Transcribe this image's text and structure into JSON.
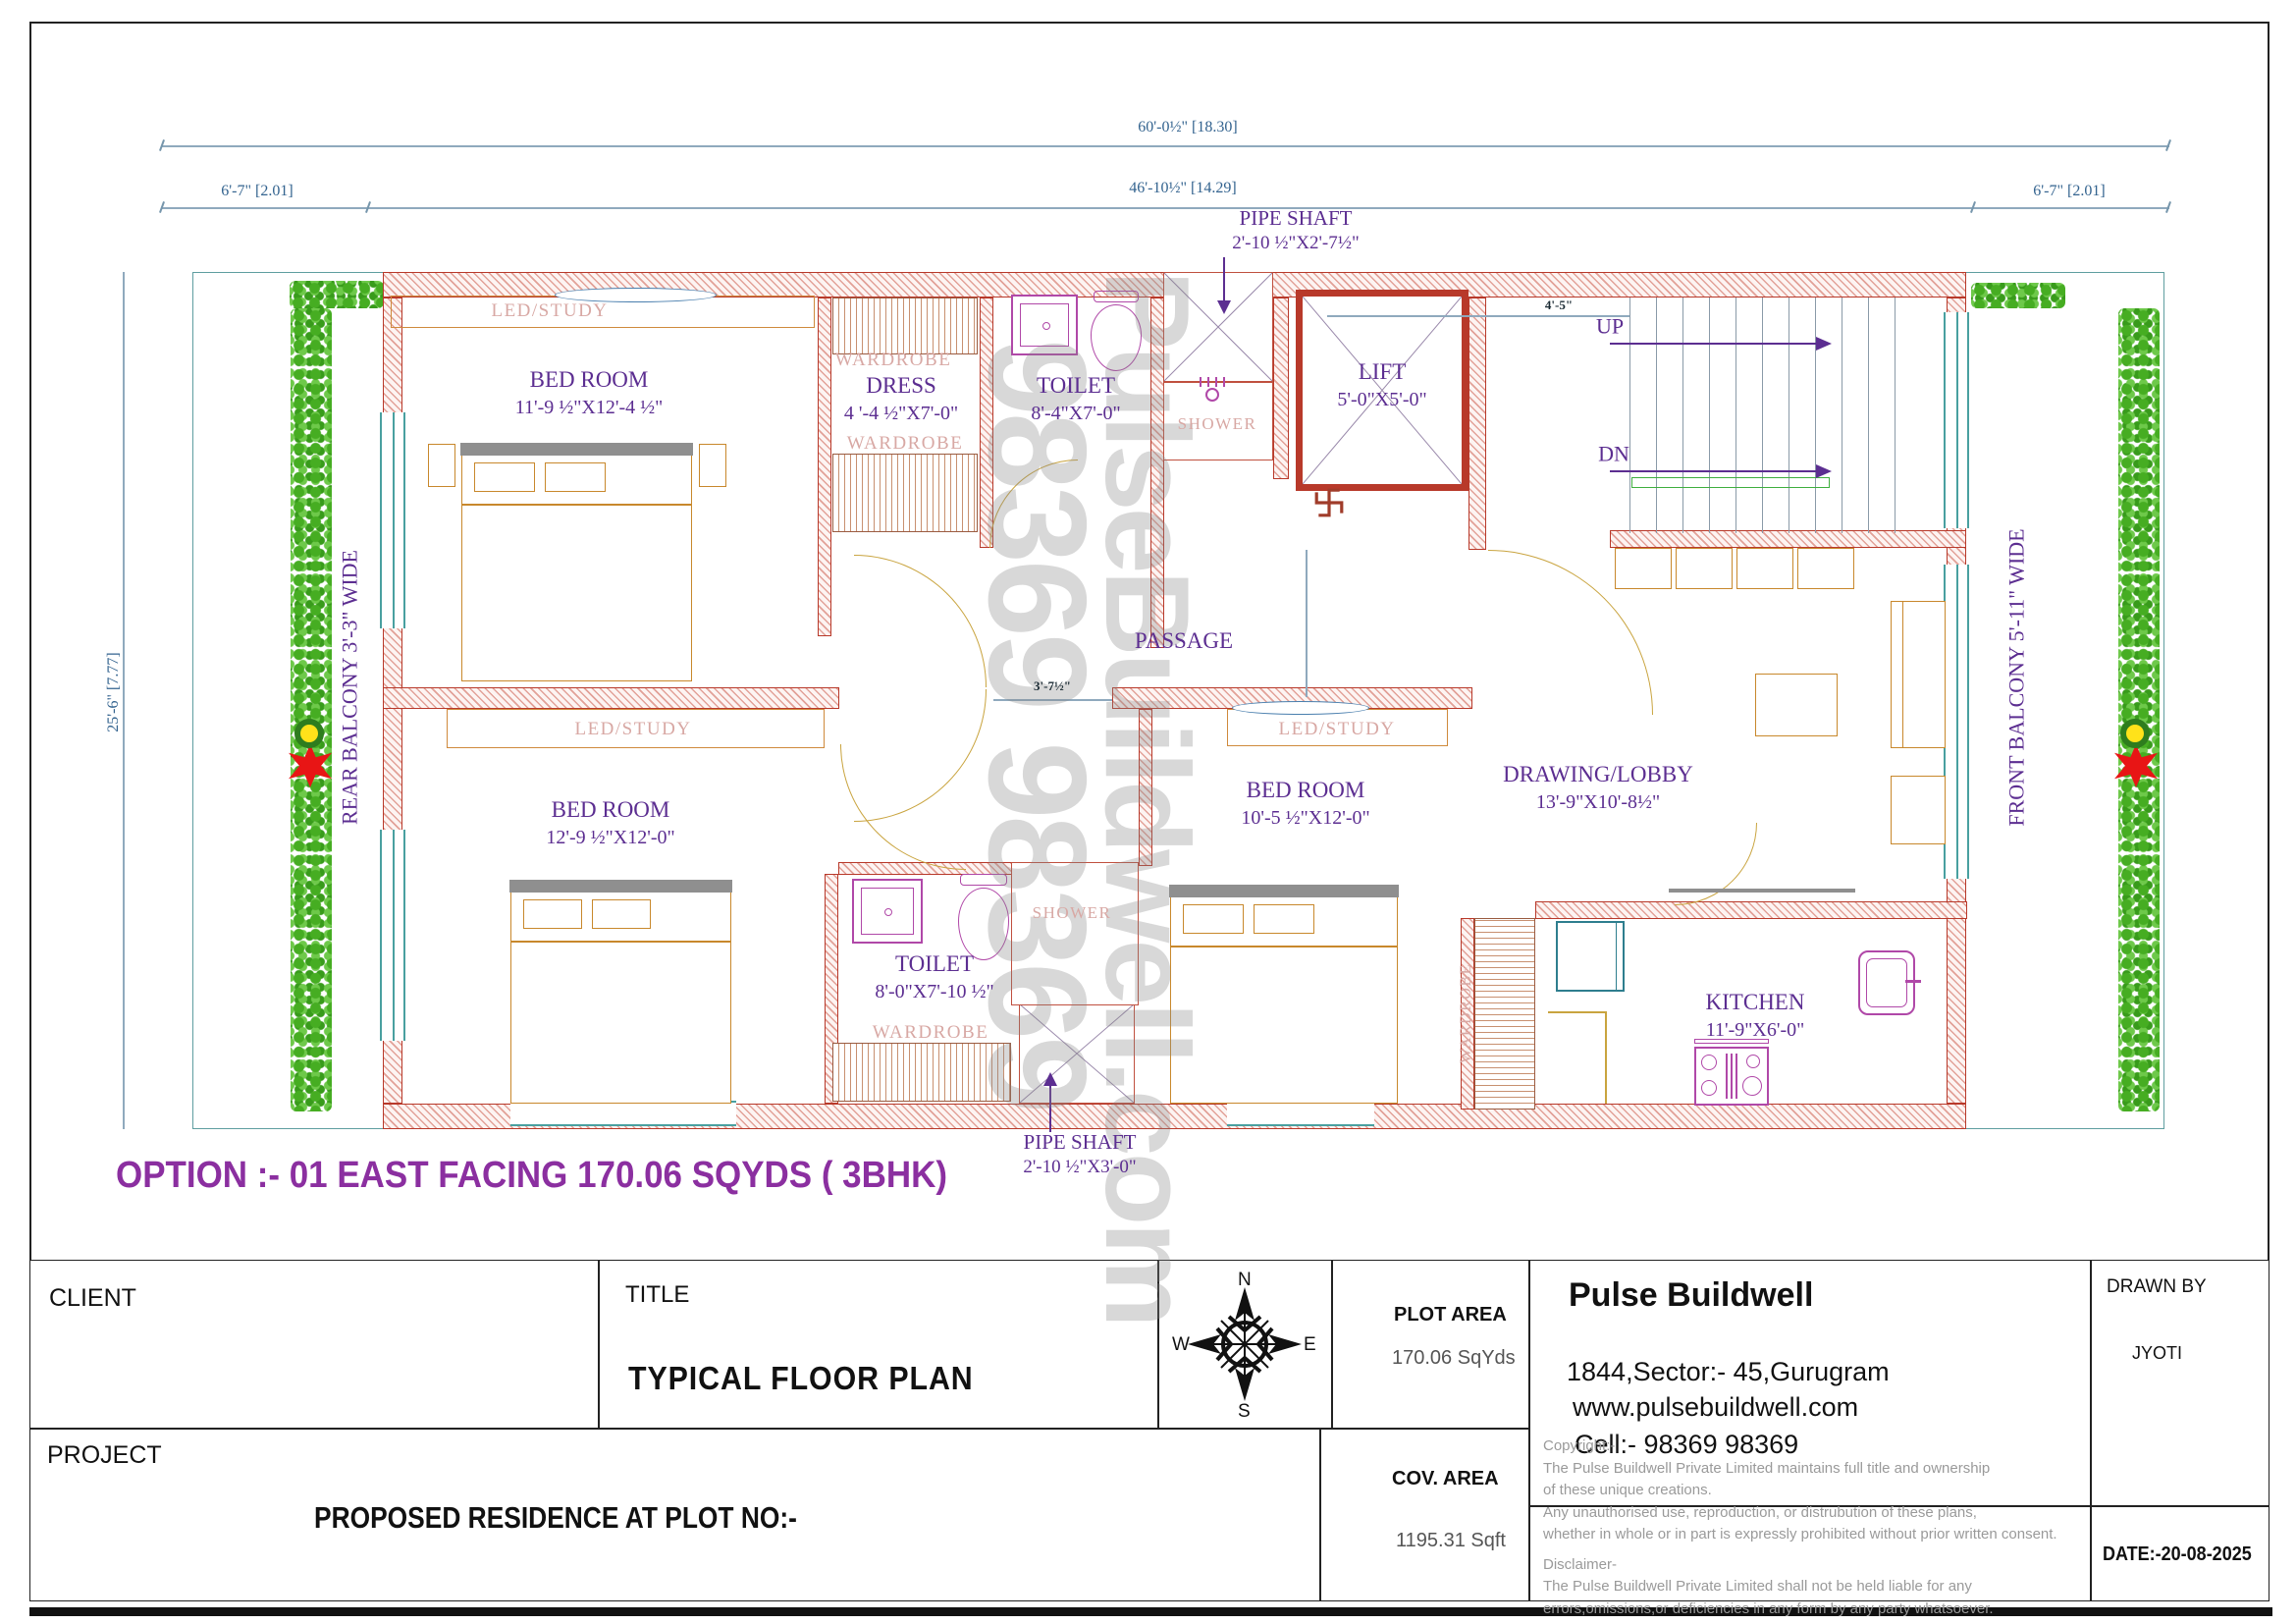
{
  "dims": {
    "total": "60'-0½\" [18.30]",
    "inner": "46'-10½\" [14.29]",
    "side_left": "6'-7\" [2.01]",
    "side_right": "6'-7\" [2.01]",
    "height": "25'-6\" [7.77]",
    "stair": "4'-5\"",
    "passage": "3'-7½\""
  },
  "rooms": {
    "bedroom1": {
      "name": "BED ROOM",
      "size": "11'-9 ½\"X12'-4 ½\""
    },
    "dress": {
      "name": "DRESS",
      "size": "4 '-4 ½\"X7'-0\""
    },
    "toilet1": {
      "name": "TOILET",
      "size": "8'-4\"X7'-0\""
    },
    "pipe_shaft_top": {
      "name": "PIPE SHAFT",
      "size": "2'-10 ½\"X2'-7½\""
    },
    "lift": {
      "name": "LIFT",
      "size": "5'-0\"X5'-0\""
    },
    "bedroom2": {
      "name": "BED ROOM",
      "size": "12'-9 ½\"X12'-0\""
    },
    "bedroom3": {
      "name": "BED ROOM",
      "size": "10'-5 ½\"X12'-0\""
    },
    "drawing_lobby": {
      "name": "DRAWING/LOBBY",
      "size": "13'-9\"X10'-8½\""
    },
    "toilet2": {
      "name": "TOILET",
      "size": "8'-0\"X7'-10 ½\""
    },
    "kitchen": {
      "name": "KITCHEN",
      "size": "11'-9\"X6'-0\""
    },
    "pipe_shaft_bottom": {
      "name": "PIPE SHAFT",
      "size": "2'-10 ½\"X3'-0\""
    }
  },
  "labels": {
    "passage": "PASSAGE",
    "shower": "SHOWER",
    "wardrobe": "WARDROBE",
    "led_study": "LED/STUDY",
    "up": "UP",
    "dn": "DN",
    "rear_balcony": "REAR  BALCONY 3'-3\" WIDE",
    "front_balcony": "FRONT  BALCONY 5'-11\" WIDE"
  },
  "option_text": "OPTION :- 01 EAST FACING 170.06 SQYDS ( 3BHK)",
  "watermark": {
    "line1": "PulseBuildwell.com",
    "line2": "98369 98369"
  },
  "title_block": {
    "client_label": "CLIENT",
    "title_label": "TITLE",
    "title_value": "TYPICAL  FLOOR PLAN",
    "compass": {
      "n": "N",
      "e": "E",
      "s": "S",
      "w": "W"
    },
    "plot_area_label": "PLOT AREA",
    "plot_area_value": "170.06 SqYds",
    "company": {
      "name": "Pulse Buildwell",
      "address": "1844,Sector:- 45,Gurugram",
      "website": "www.pulsebuildwell.com",
      "cell": "Cell:- 98369 98369"
    },
    "drawn_by_label": "DRAWN BY",
    "drawn_by_value": "JYOTI",
    "project_label": "PROJECT",
    "project_value": "PROPOSED RESIDENCE AT PLOT NO:-",
    "cov_area_label": "COV. AREA",
    "cov_area_value": "1195.31 Sqft",
    "copyright_lines": [
      "Copyright:-",
      "The Pulse Buildwell Private Limited maintains full title and ownership",
      " of these unique creations.",
      "Any unauthorised use, reproduction, or distrubution of these plans,",
      "whether in whole or in part is expressly prohibited without prior written consent.",
      "Disclaimer-",
      "The Pulse Buildwell Private Limited shall not be held liable for any",
      "errors,omissions,or deficiencies in any form by any party whatsoever."
    ],
    "date_value": "DATE:-20-08-2025"
  },
  "palette": {
    "wall_red": "#b8392a",
    "label_purple": "#5c2e91",
    "dim_blue": "#33638f",
    "hedge_green": "#46ad22",
    "fixture_magenta": "#b048a8",
    "furniture_tan": "#c8882c",
    "door_arc": "#c9a43f",
    "boundary_teal": "#5f9ea0",
    "soft_pink": "#d8a8a4",
    "option_purple": "#8b2fa0"
  }
}
